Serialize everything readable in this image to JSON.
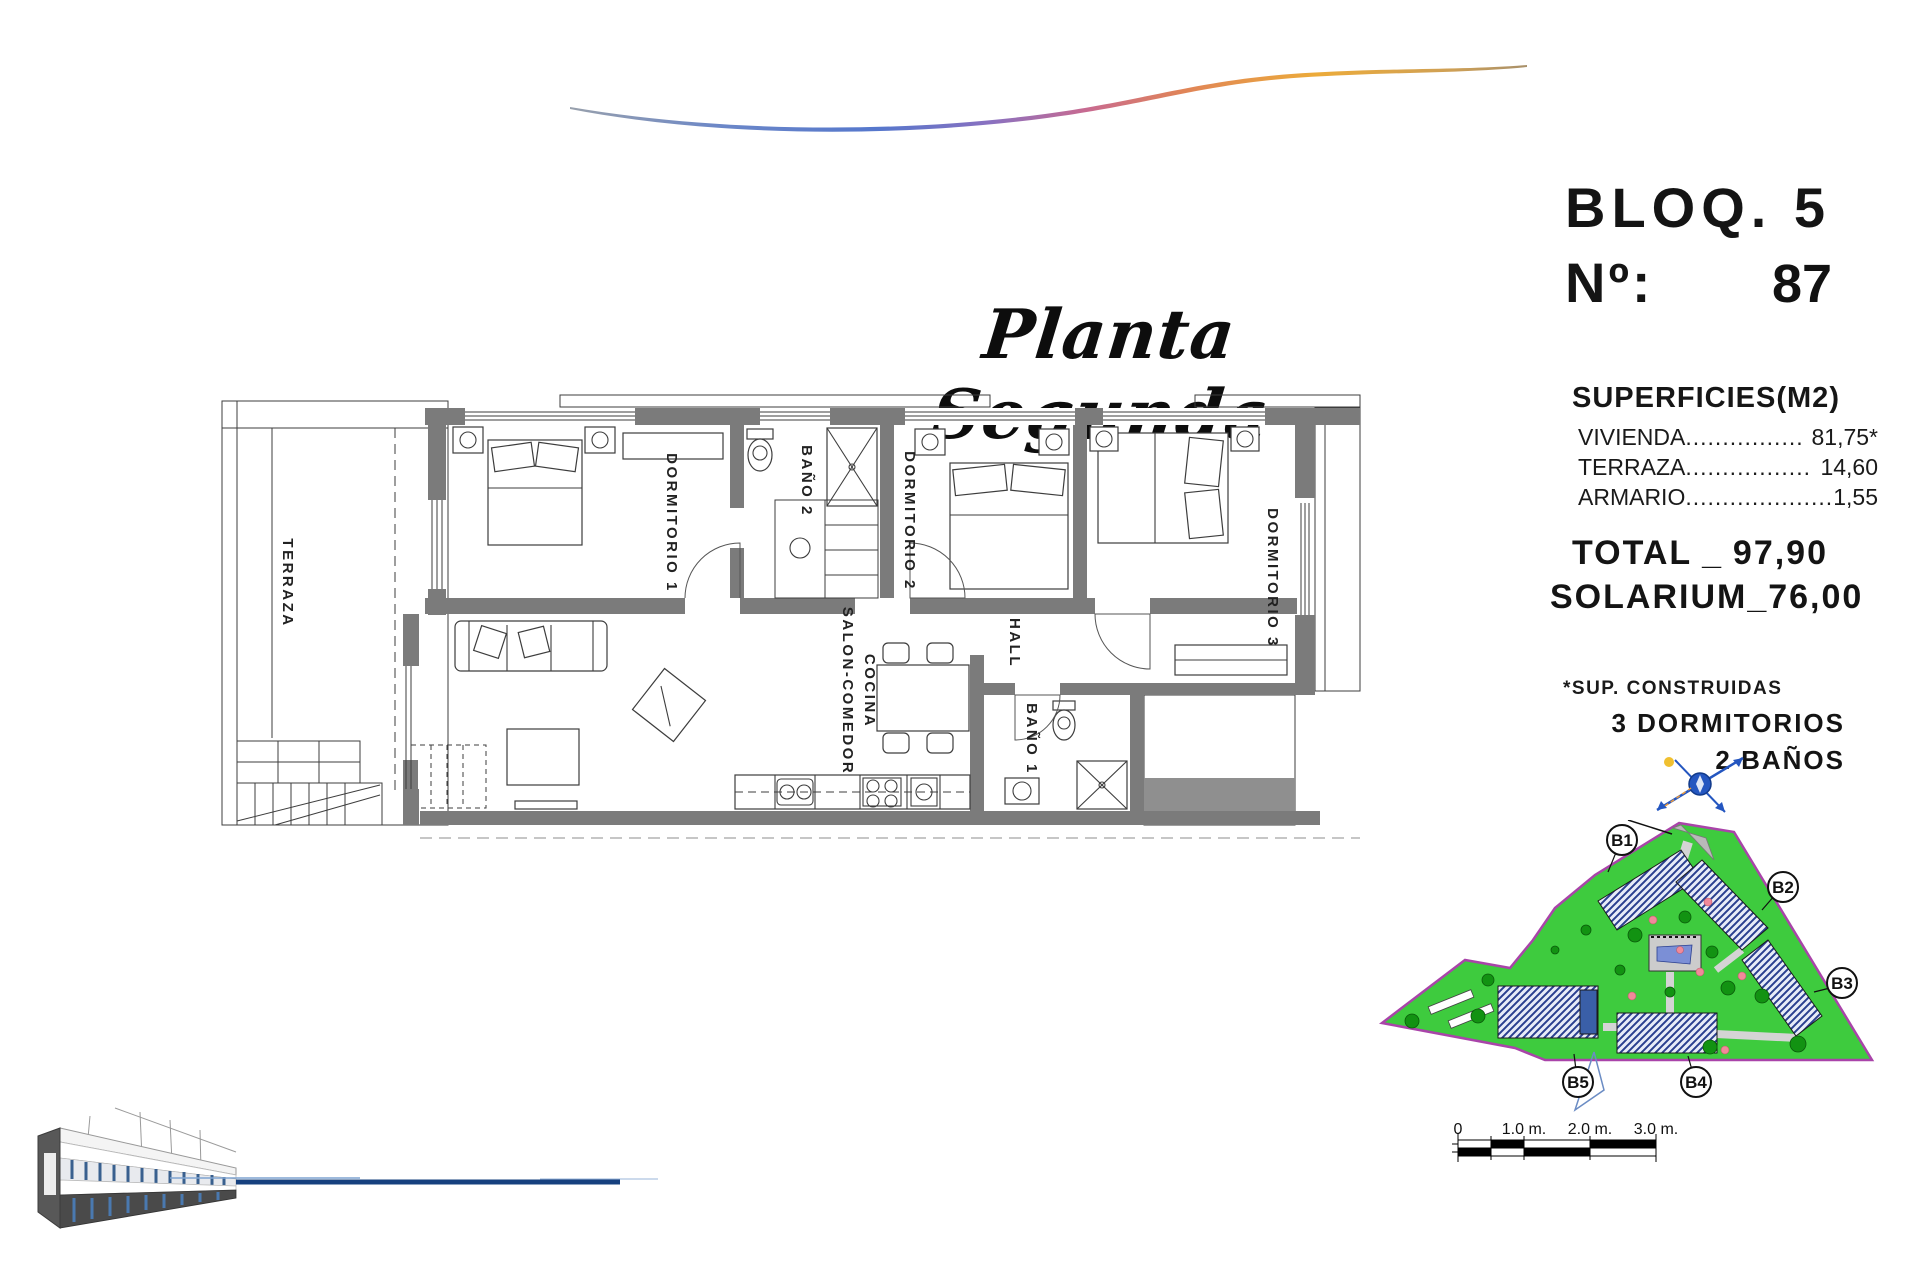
{
  "title": "Planta Segunda",
  "header": {
    "bloq_label": "BLOQ. 5",
    "no_label": "Nº:",
    "no_value": "87"
  },
  "superficies": {
    "heading": "SUPERFICIES(M2)",
    "rows": [
      {
        "label": "VIVIENDA",
        "dots": "................",
        "value": "81,75*"
      },
      {
        "label": "TERRAZA",
        "dots": ".................",
        "value": "14,60"
      },
      {
        "label": "ARMARIO",
        "dots": "....................",
        "value": "1,55"
      }
    ],
    "total_label": "TOTAL",
    "total_sep": "_",
    "total_value": "97,90",
    "solarium_label": "SOLARIUM_",
    "solarium_value": "76,00",
    "footnote": "*SUP. CONSTRUIDAS",
    "program": [
      "3 DORMITORIOS",
      "2 BAÑOS"
    ]
  },
  "floorplan": {
    "rooms": [
      "TERRAZA",
      "DORMITORIO 1",
      "BAÑO 2",
      "DORMITORIO 2",
      "DORMITORIO 3",
      "SALON-COMEDOR",
      "COCINA",
      "HALL",
      "BAÑO 1"
    ]
  },
  "siteplan": {
    "blocks": [
      "B1",
      "B2",
      "B3",
      "B4",
      "B5"
    ]
  },
  "scalebar": {
    "labels": [
      "0",
      "1.0 m.",
      "2.0 m.",
      "3.0 m."
    ]
  },
  "colors": {
    "lawn_green": "#3ecb3e",
    "boundary_magenta": "#a944a9",
    "pool_blue": "#7b8fd6",
    "roof_hatch_navy": "#2a3f8f",
    "accent_line_navy": "#16407e",
    "wall_gray": "#7b7b7b"
  }
}
